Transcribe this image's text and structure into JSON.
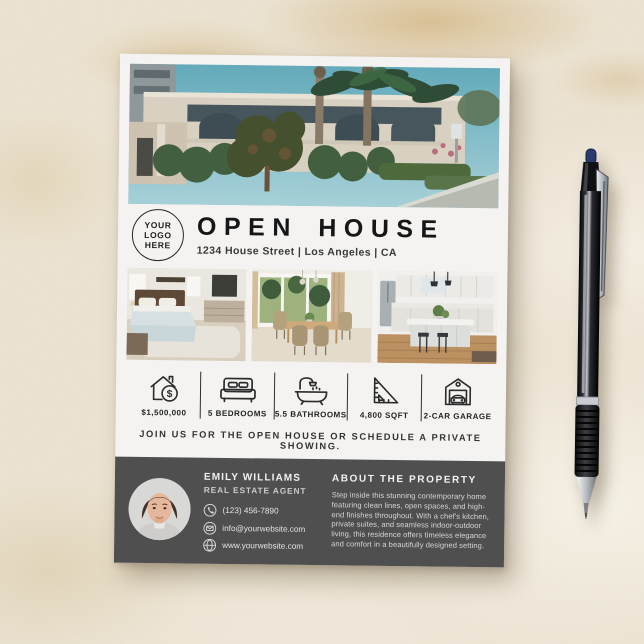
{
  "scene": {
    "surface_color": "#ece4d4",
    "pen": {
      "kind": "ballpoint-pen",
      "barrel_color": "#111418",
      "plunger_color": "#2b3a6e",
      "grip_color": "#1a1a1a",
      "tip_color": "#aeb2b6"
    }
  },
  "flyer": {
    "paper_color": "#f4f3f1",
    "footer_color": "#4f4f4f",
    "logo": {
      "line1": "YOUR",
      "line2": "LOGO",
      "line3": "HERE"
    },
    "title": "OPEN HOUSE",
    "address": "1234 House Street | Los Angeles | CA",
    "photos": {
      "main": "house-exterior-photo",
      "left": "bedroom-photo",
      "center": "dining-room-photo",
      "right": "kitchen-photo"
    },
    "features": [
      {
        "icon": "house-dollar-icon",
        "label": "$1,500,000"
      },
      {
        "icon": "bed-icon",
        "label": "5 BEDROOMS"
      },
      {
        "icon": "bathtub-icon",
        "label": "5.5 BATHROOMS"
      },
      {
        "icon": "set-square-icon",
        "label": "4,800 SQFT"
      },
      {
        "icon": "garage-car-icon",
        "label": "2-CAR GARAGE"
      }
    ],
    "cta": "JOIN US FOR THE OPEN HOUSE OR SCHEDULE A PRIVATE SHOWING.",
    "footer": {
      "agent": {
        "name": "EMILY WILLIAMS",
        "title": "REAL ESTATE AGENT"
      },
      "contacts": [
        {
          "icon": "phone-icon",
          "value": "(123) 456-7890"
        },
        {
          "icon": "email-icon",
          "value": "info@yourwebsite.com"
        },
        {
          "icon": "globe-icon",
          "value": "www.yourwebsite.com"
        }
      ],
      "about": {
        "heading": "ABOUT THE PROPERTY",
        "text": "Step inside this stunning contemporary home featuring clean lines, open spaces, and high-end finishes throughout. With a chef's kitchen, private suites, and seamless indoor-outdoor living, this residence offers timeless elegance and comfort in a beautifully designed setting."
      }
    }
  }
}
